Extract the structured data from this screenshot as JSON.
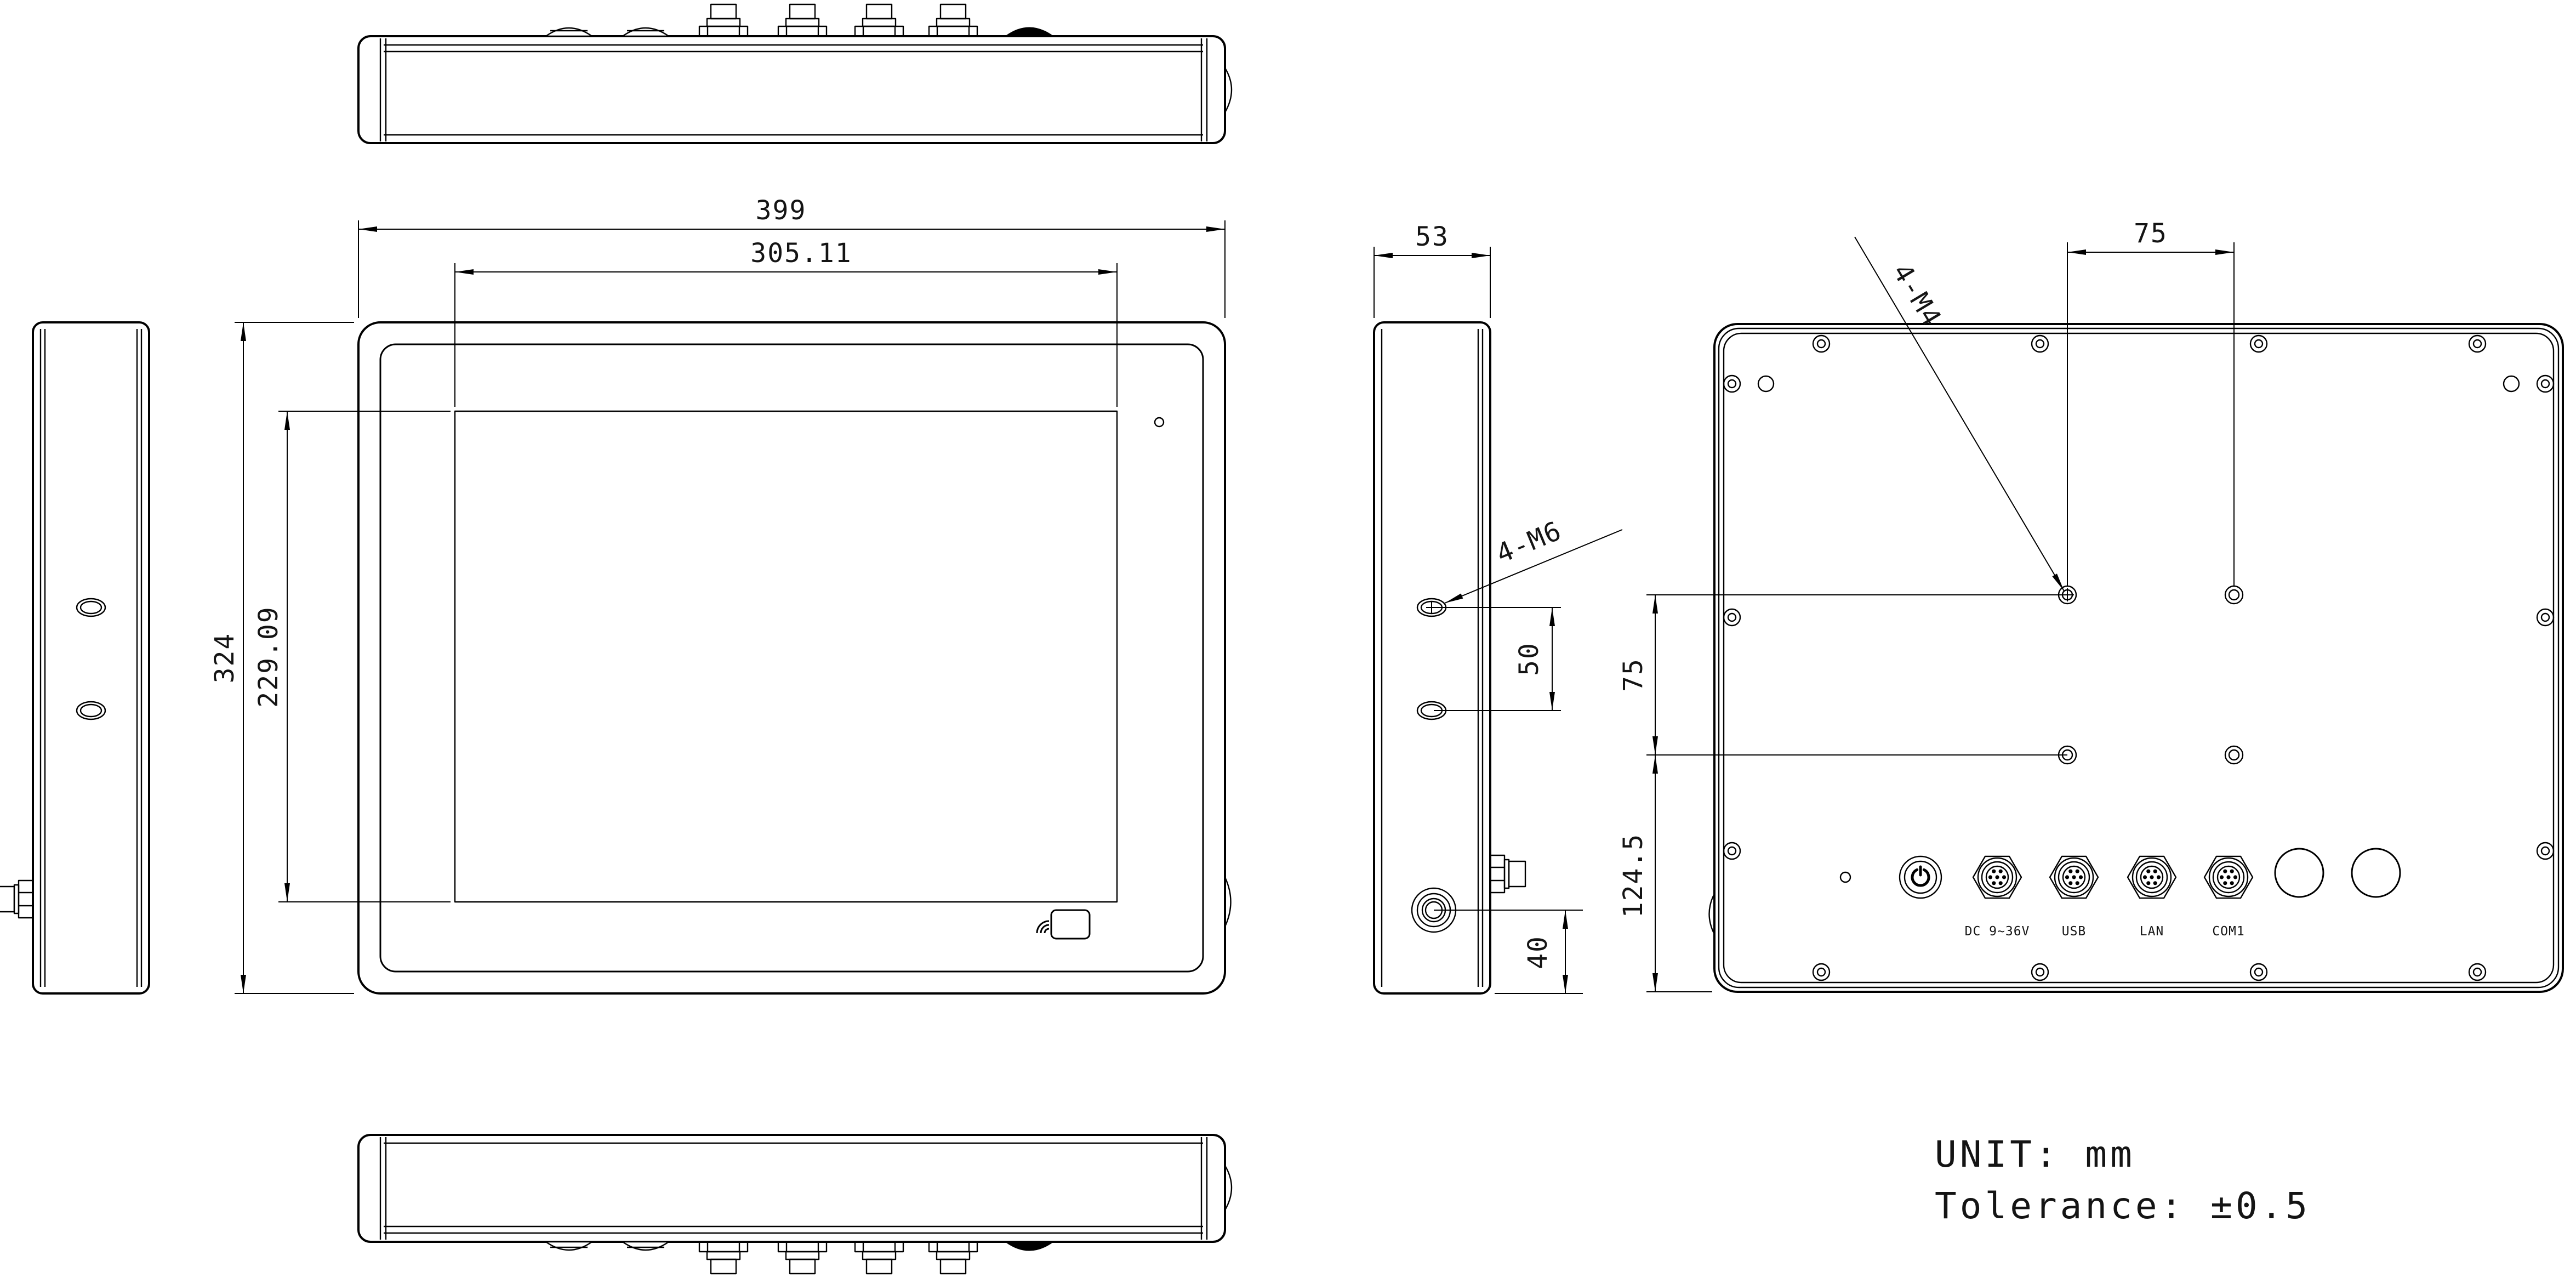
{
  "drawing": {
    "dims": {
      "front_width": "399",
      "display_width": "305.11",
      "front_height": "324",
      "display_height": "229.09",
      "depth": "53",
      "vesa_horizontal": "75",
      "vesa_vertical": "75",
      "vesa_thread": "4-M4",
      "side_thread": "4-M6",
      "side_hole_spacing": "50",
      "rear_bottom_offset": "124.5",
      "antenna_offset": "40"
    },
    "ports": {
      "dc": "DC 9~36V",
      "usb": "USB",
      "lan": "LAN",
      "com": "COM1"
    },
    "notes": {
      "unit": "UNIT: mm",
      "tolerance": "Tolerance: ±0.5"
    }
  }
}
